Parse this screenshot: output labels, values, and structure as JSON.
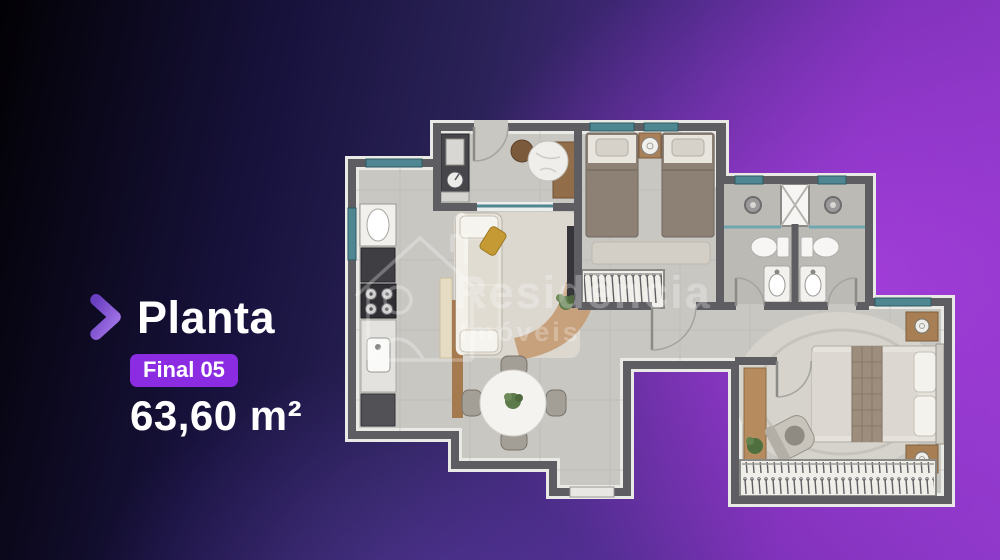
{
  "panel": {
    "chevron_icon": "chevron-right",
    "title": "Planta",
    "badge": "Final 05",
    "area": "63,60 m²"
  },
  "watermark": {
    "line1": "Residência",
    "line2": "Imóveis",
    "logo_icon": "house-person-outline"
  },
  "colors": {
    "badge_bg": "#8b2ce2",
    "chevron_gradient_from": "#6a3fc0",
    "chevron_gradient_to": "#a678ea",
    "background_bright_purple": "#8c38c8",
    "background_dark": "#0a0620",
    "plan_wall": "#5d5d62",
    "plan_floor": "#c9c7c2",
    "window_glass": "#4e8691",
    "wood": "#a87f55"
  }
}
